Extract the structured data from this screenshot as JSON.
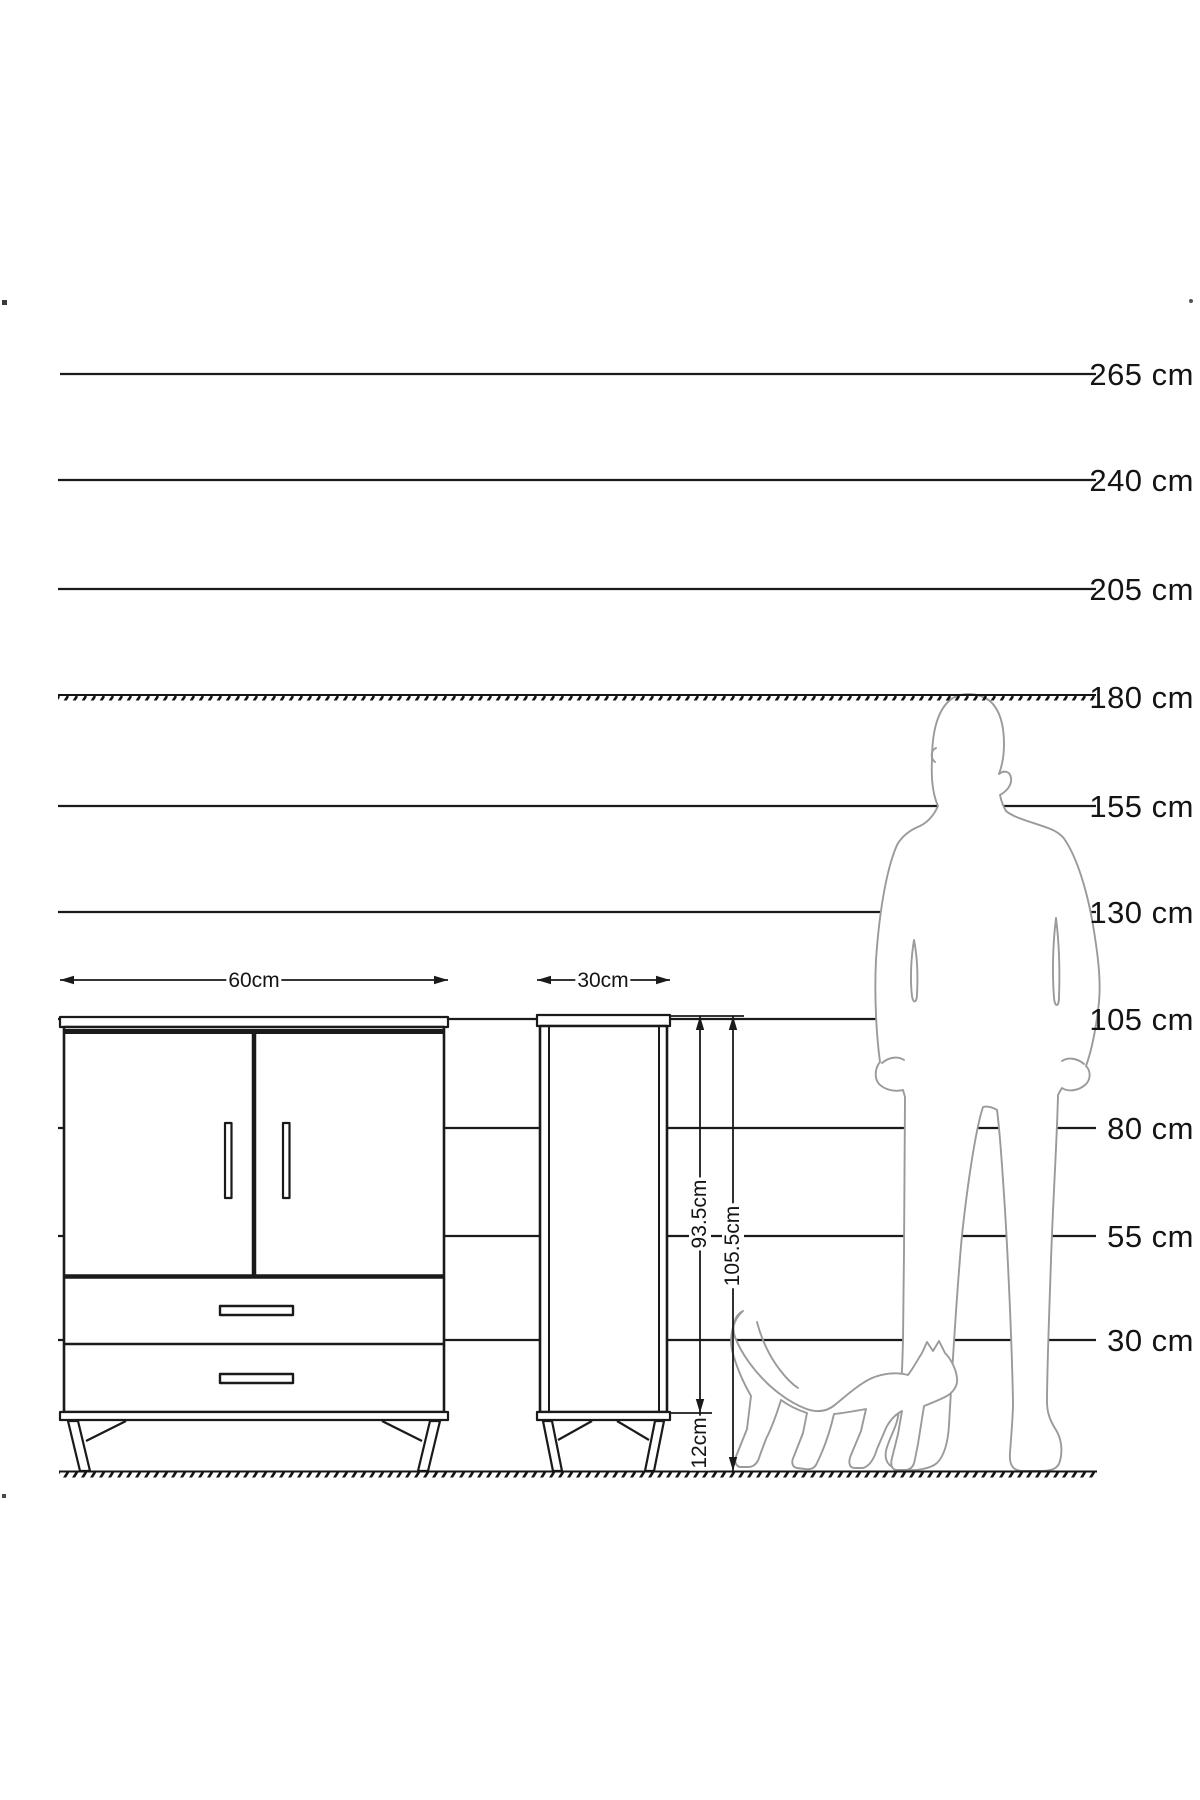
{
  "diagram_title": "furniture-size-chart",
  "colors": {
    "line": "#1a1a1a",
    "figure_outline": "#9a9a9a",
    "background": "#ffffff"
  },
  "scale": {
    "unit": "cm",
    "labels": [
      "265 cm",
      "240 cm",
      "205 cm",
      "180 cm",
      "155 cm",
      "130 cm",
      "105 cm",
      "80 cm",
      "55 cm",
      "30 cm"
    ]
  },
  "dims": {
    "large_width": "60cm",
    "small_width": "30cm",
    "body_height": "93.5cm",
    "total_height": "105.5cm",
    "leg_height": "12cm"
  },
  "figures": {
    "man": "man-silhouette-180cm",
    "cat": "cat-silhouette"
  }
}
